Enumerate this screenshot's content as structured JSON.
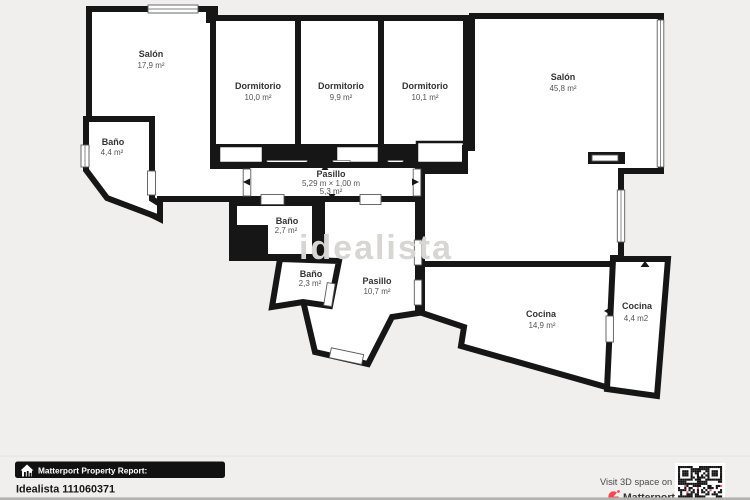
{
  "floorplan": {
    "watermark": "idealista",
    "rooms": {
      "salon_left": {
        "name": "Salón",
        "area": "17,9 m²"
      },
      "dorm_1": {
        "name": "Dormitorio",
        "area": "10,0 m²"
      },
      "dorm_2": {
        "name": "Dormitorio",
        "area": "9,9 m²"
      },
      "dorm_3": {
        "name": "Dormitorio",
        "area": "10,1 m²"
      },
      "salon_right": {
        "name": "Salón",
        "area": "45,8 m²"
      },
      "bano_44": {
        "name": "Baño",
        "area": "4,4 m²"
      },
      "pasillo_main": {
        "name": "Pasillo",
        "dims": "5,29 m × 1,00 m",
        "area": "5,3 m²"
      },
      "bano_27": {
        "name": "Baño",
        "area": "2,7 m²"
      },
      "bano_23": {
        "name": "Baño",
        "area": "2,3 m²"
      },
      "pasillo_107": {
        "name": "Pasillo",
        "area": "10,7 m²"
      },
      "cocina_149": {
        "name": "Cocina",
        "area": "14,9 m²"
      },
      "cocina_44": {
        "name": "Cocina",
        "area": "4,4 m2"
      }
    }
  },
  "footer": {
    "badge_label": "Matterport Property Report:",
    "property_id": "Idealista 111060371",
    "visit_text": "Visit 3D space on",
    "brand_name": "Matterport"
  },
  "icons": {
    "badge": "house-icon",
    "brand": "matterport-logo",
    "qr": "qr-code"
  },
  "colors": {
    "wall": "#161616",
    "background": "#f0efed",
    "room": "#ffffff",
    "watermark": "#d7d6d3",
    "brand_red": "#f14a55"
  }
}
